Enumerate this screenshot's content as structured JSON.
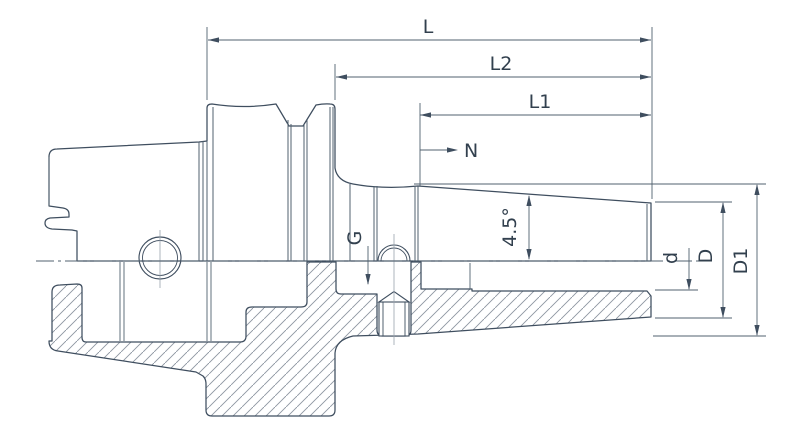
{
  "drawing": {
    "type": "engineering-drawing",
    "subject": "shrink-fit tool holder with hollow taper shank, half section view",
    "colors": {
      "background": "#ffffff",
      "outline": "#3f4e5f",
      "thin_line": "#51616f",
      "hatch": "#8b95a0",
      "text": "#32404e"
    },
    "dimensions": {
      "overall_length": {
        "label": "L"
      },
      "length_l2": {
        "label": "L2"
      },
      "length_l1": {
        "label": "L1"
      },
      "clamp_note": {
        "label": "N"
      },
      "thread": {
        "label": "G"
      },
      "taper_angle": {
        "label": "4.5°"
      },
      "bore_diameter": {
        "label": "d"
      },
      "nose_diameter": {
        "label": "D"
      },
      "body_diameter": {
        "label": "D1"
      }
    }
  }
}
